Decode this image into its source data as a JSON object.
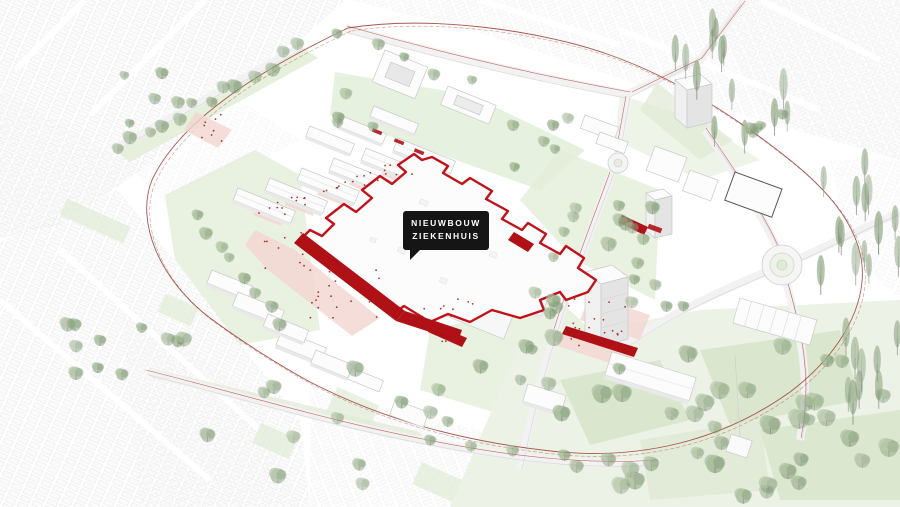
{
  "scene": {
    "description": "Axonometric masterplan illustration of a hospital campus with the new hospital building highlighted in red, surrounded by urban fabric, tree-lined avenues, parks and roundabouts"
  },
  "label": {
    "line1": "NIEUWBOUW",
    "line2": "ZIEKENHUIS"
  },
  "colors": {
    "background": "#ffffff",
    "fabric_line": "#e2e2e2",
    "lawn": "#e3eed9",
    "lawn_dark": "#d5e3c8",
    "tree_light": "#a9bd9c",
    "tree_mid": "#8aa37e",
    "tree_dark": "#6f8c66",
    "pine": "#7d9471",
    "accent_red": "#b01116",
    "outline_red": "#c1121a",
    "boundary_red": "#9a3b30",
    "plaza_pink": "#f3d6d1",
    "people_red": "#9b1212",
    "building": "#fcfcfc",
    "building_side": "#e9e9e9",
    "building_stroke": "#c9c9c9",
    "road": "#f5f5f5",
    "label_bg": "#151515",
    "label_text": "#ffffff"
  }
}
